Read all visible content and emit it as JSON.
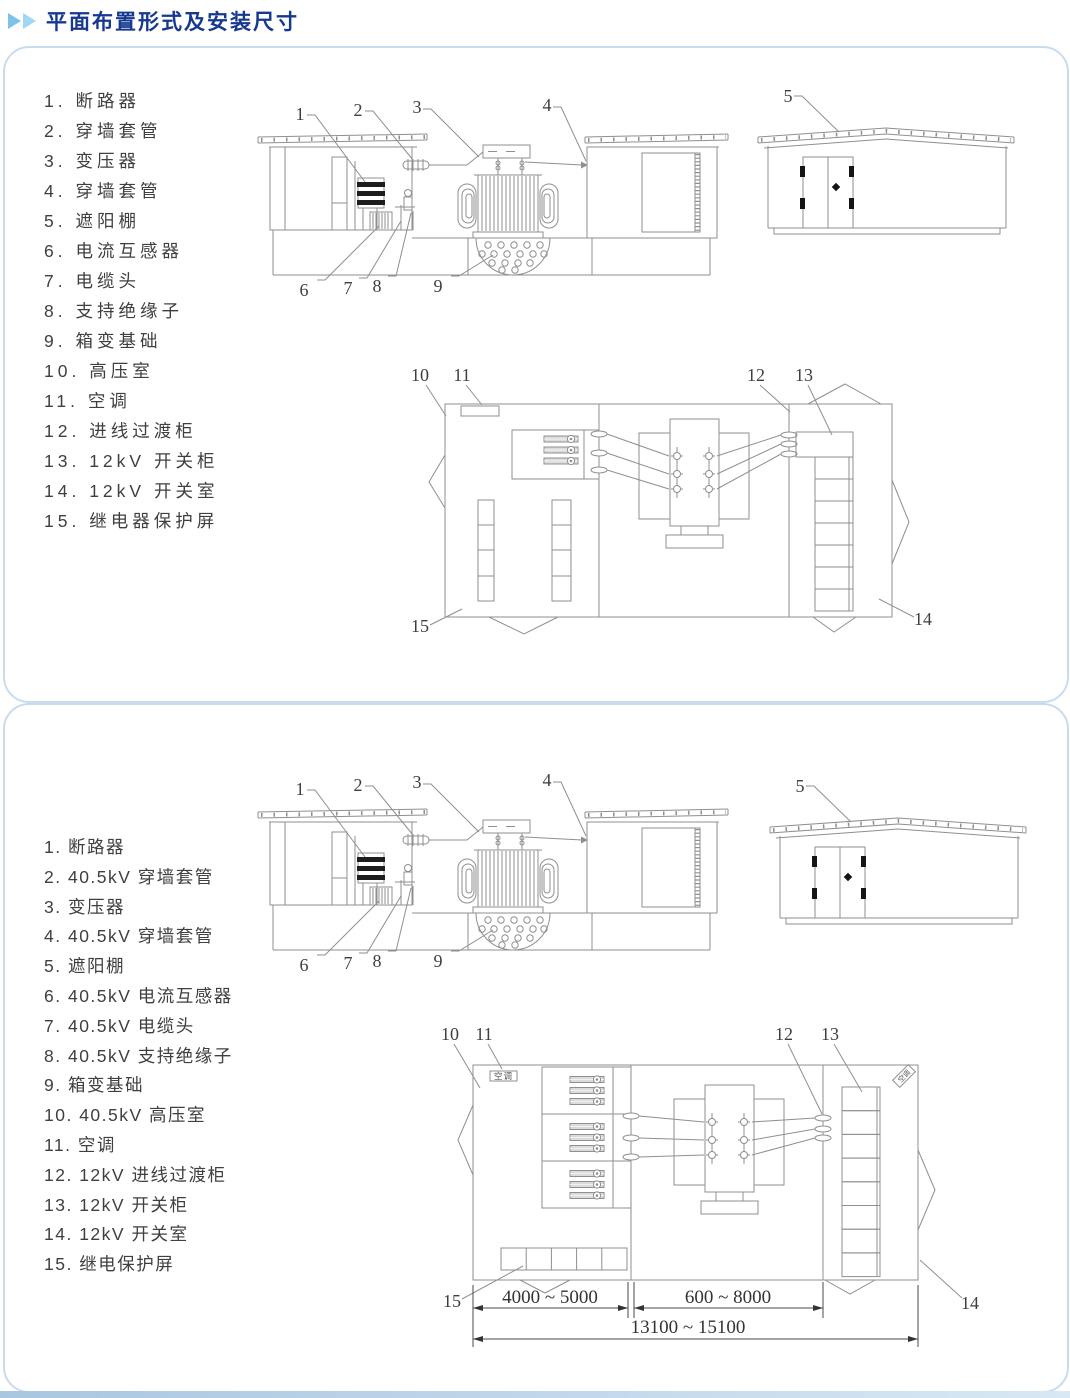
{
  "header": {
    "title": "平面布置形式及安装尺寸"
  },
  "colors": {
    "title": "#16398f",
    "arrow": "#7cc3ea",
    "panel_border": "#c8dcee",
    "line": "#8f8f8f"
  },
  "panel_top": {
    "legend": [
      "1. 断路器",
      "2. 穿墙套管",
      "3. 变压器",
      "4. 穿墙套管",
      "5. 遮阳棚",
      "6. 电流互感器",
      "7. 电缆头",
      "8. 支持绝缘子",
      "9. 箱变基础",
      "10. 高压室",
      "11. 空调",
      "12. 进线过渡柜",
      "13. 12kV 开关柜",
      "14. 12kV 开关室",
      "15. 继电器保护屏"
    ],
    "callouts": {
      "n1": "1",
      "n2": "2",
      "n3": "3",
      "n4": "4",
      "n5": "5",
      "n6": "6",
      "n7": "7",
      "n8": "8",
      "n9": "9",
      "n10": "10",
      "n11": "11",
      "n12": "12",
      "n13": "13",
      "n14": "14",
      "n15": "15"
    }
  },
  "panel_bottom": {
    "legend": [
      "1. 断路器",
      "2. 40.5kV 穿墙套管",
      "3. 变压器",
      "4. 40.5kV 穿墙套管",
      "5. 遮阳棚",
      "6. 40.5kV 电流互感器",
      "7. 40.5kV 电缆头",
      "8. 40.5kV 支持绝缘子",
      "9. 箱变基础",
      "10. 40.5kV 高压室",
      "11. 空调",
      "12. 12kV 进线过渡柜",
      "13. 12kV 开关柜",
      "14. 12kV 开关室",
      "15. 继电保护屏"
    ],
    "callouts": {
      "n1": "1",
      "n2": "2",
      "n3": "3",
      "n4": "4",
      "n5": "5",
      "n6": "6",
      "n7": "7",
      "n8": "8",
      "n9": "9",
      "n10": "10",
      "n11": "11",
      "n12": "12",
      "n13": "13",
      "n14": "14",
      "n15": "15"
    },
    "ac_label": "空调",
    "dimensions": {
      "d1": "4000 ~ 5000",
      "d2": "600 ~ 8000",
      "total": "13100 ~ 15100"
    }
  }
}
